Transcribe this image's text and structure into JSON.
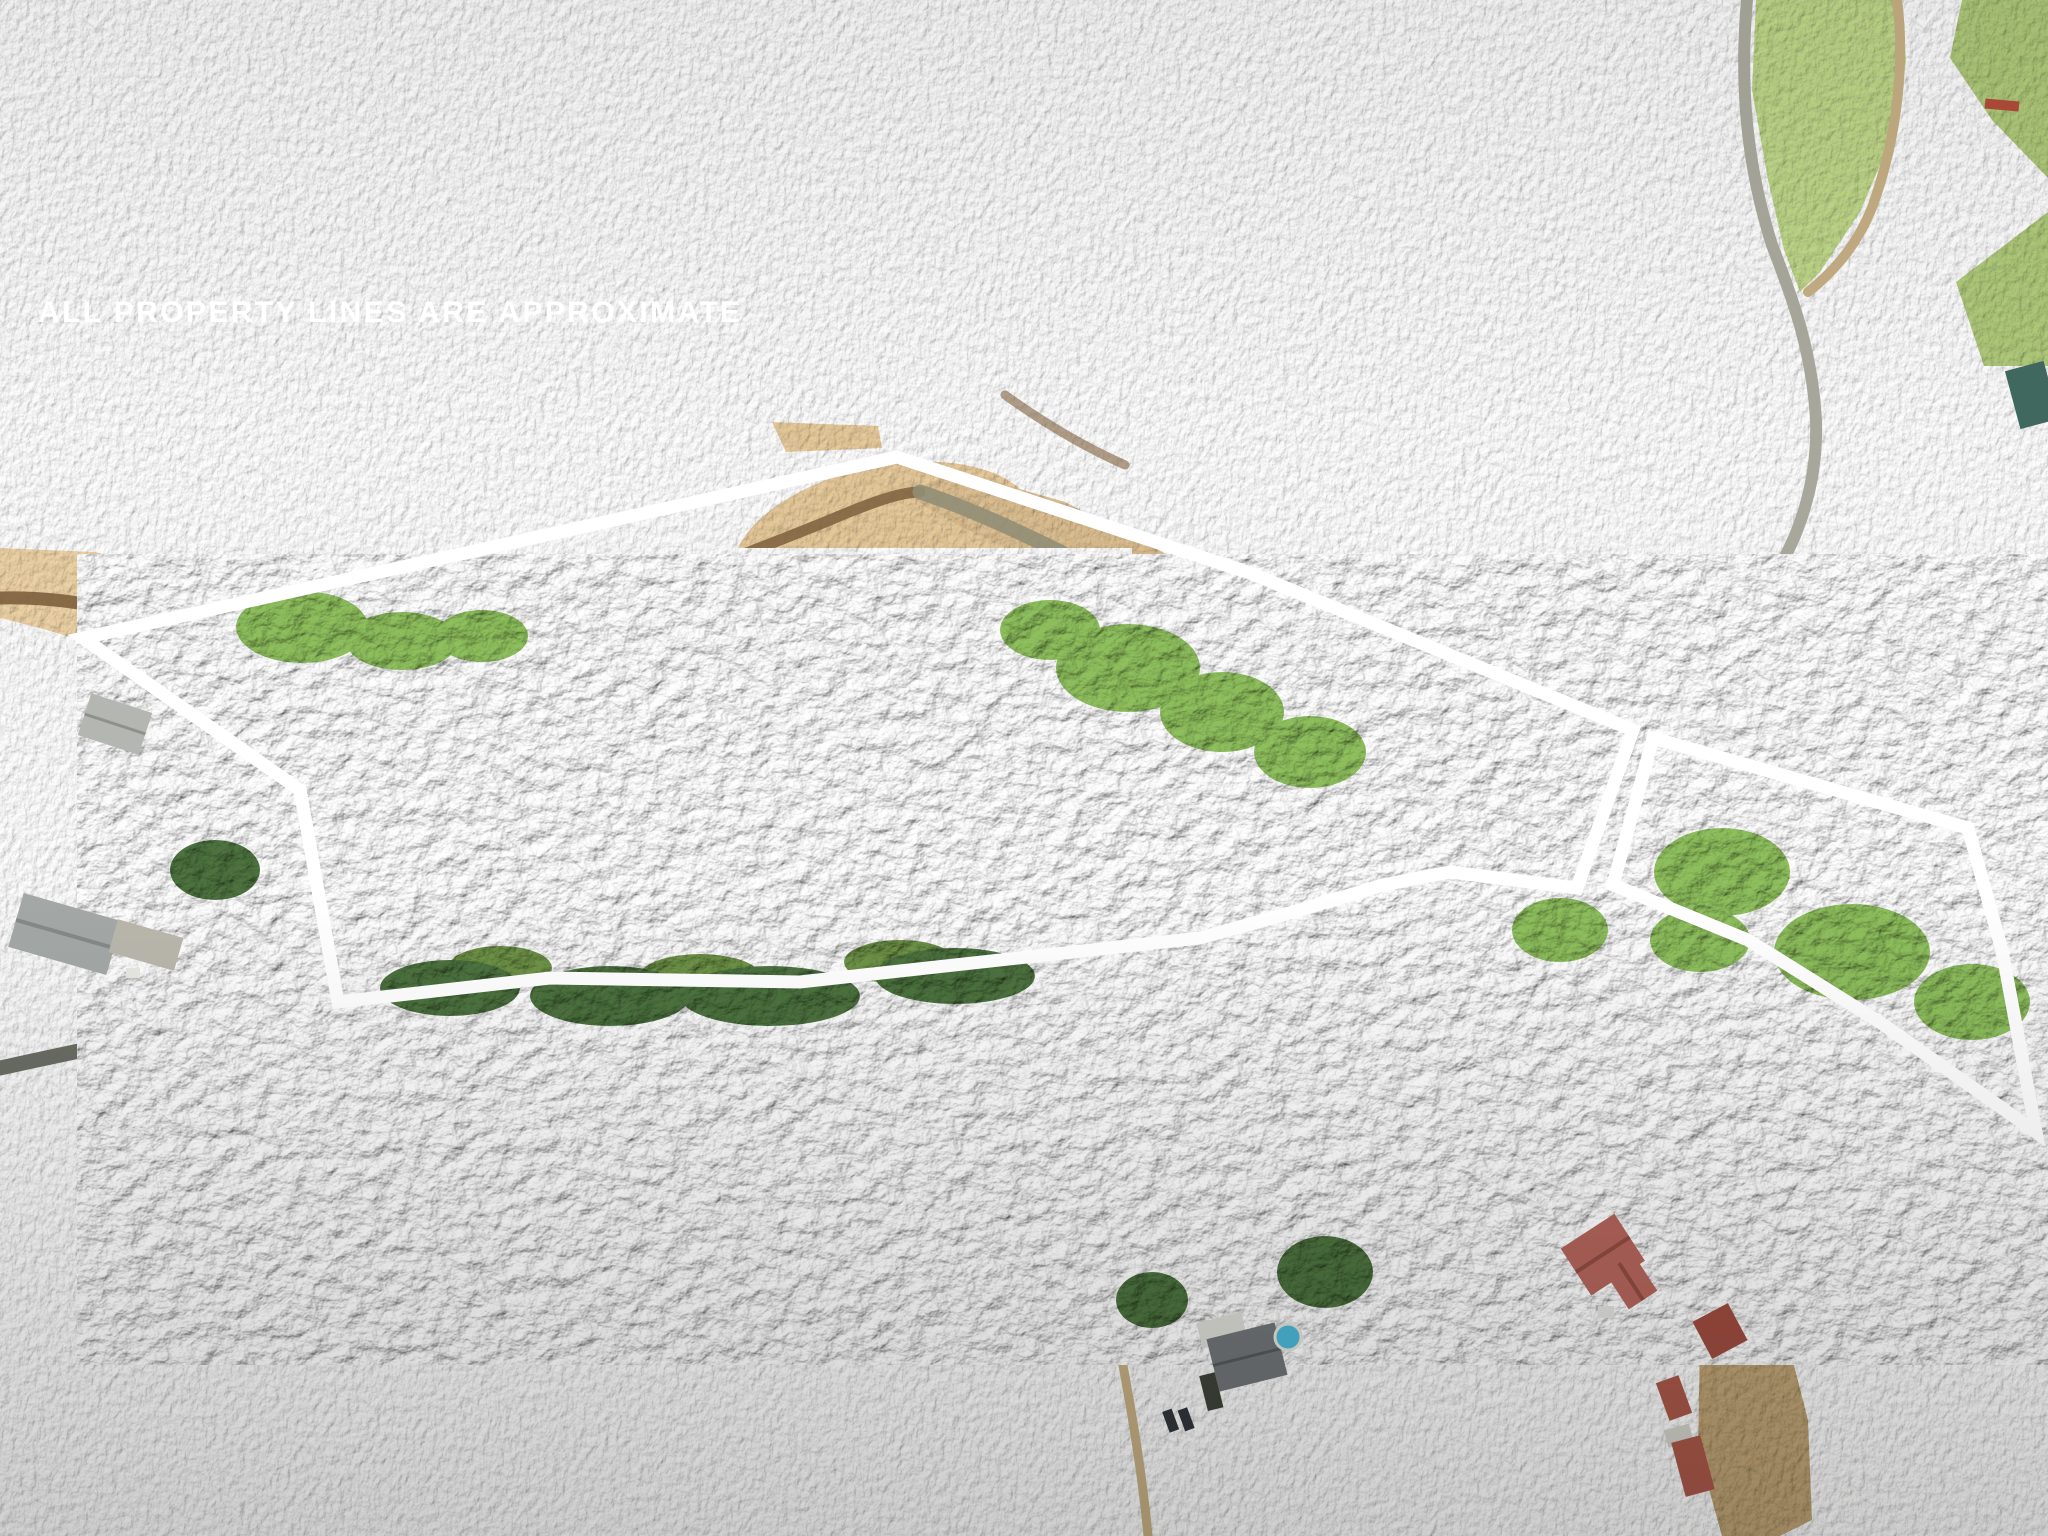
{
  "overlay": {
    "disclaimer": "ALL PROPERTY LINES ARE APPROXIMATE",
    "text_color": "#ffffff",
    "boundary_color": "#ffffff",
    "boundary_width": "13"
  },
  "property_outlines": {
    "main_parcel": {
      "label": "main-parcel-boundary",
      "points": "83,638 897,457 1250,573 1633,730 1577,888 1450,872 1383,885 1300,910 1200,938 800,982 550,978 338,1002 300,790"
    },
    "road_parcel": {
      "label": "secondary-parcel-boundary",
      "points": "1653,738 1968,828 2002,950 2036,1132 1881,1023 1748,940 1613,885"
    }
  },
  "scene": {
    "description": "aerial drone photo of wooded acreage with cleared hay field, creek, country road, and neighboring homes",
    "palette": {
      "forest_dark": "#2e4526",
      "forest_base": "#3d5c33",
      "forest_light": "#517539",
      "lime_trees": "#83b355",
      "field": "#a9bf72",
      "mow_line": "#d6cf96",
      "pasture": "#8fae62",
      "sand": "#d9bd8f",
      "creek_brown": "#7d5f3c",
      "creek_gray": "#8f8c74",
      "road_gray": "#6a6d64",
      "road_light": "#a2a49a",
      "dirt_track": "#c3ac82",
      "roof_red": "#b2635a",
      "roof_barn_red": "#9c4a3e",
      "roof_gray": "#6e7276",
      "barn_gray": "#a3a8a6",
      "pool_blue": "#4ab5d6"
    }
  }
}
